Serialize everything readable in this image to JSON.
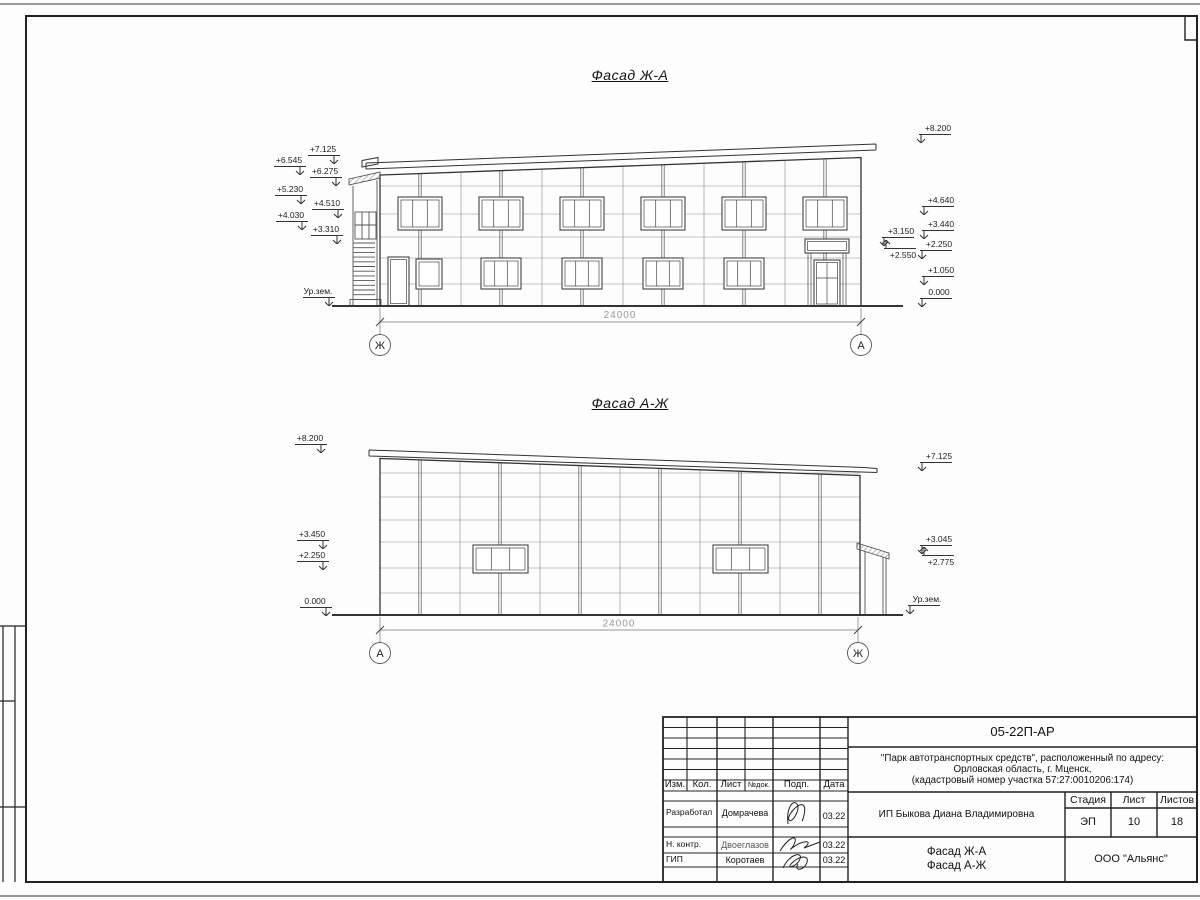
{
  "drawing": {
    "facade1": {
      "title": "Фасад Ж-А",
      "dimension": "24000",
      "axis_left": "Ж",
      "axis_right": "А",
      "marks": [
        {
          "label": "+7.125",
          "x": 308,
          "y": 155,
          "arrow": "r"
        },
        {
          "label": "+6.545",
          "x": 274,
          "y": 166,
          "arrow": "r"
        },
        {
          "label": "+6.275",
          "x": 310,
          "y": 177,
          "arrow": "r"
        },
        {
          "label": "+5.230",
          "x": 275,
          "y": 195,
          "arrow": "r"
        },
        {
          "label": "+4.510",
          "x": 312,
          "y": 209,
          "arrow": "r"
        },
        {
          "label": "+4.030",
          "x": 276,
          "y": 221,
          "arrow": "r"
        },
        {
          "label": "+3.310",
          "x": 311,
          "y": 235,
          "arrow": "r"
        },
        {
          "label": "Ур.зем.",
          "x": 303,
          "y": 297,
          "arrow": "r"
        },
        {
          "label": "+3.150",
          "x": 878,
          "y": 237,
          "arrow": "l"
        },
        {
          "label": "+2.550",
          "x": 880,
          "y": 248,
          "arrow": "l",
          "flip": true
        },
        {
          "label": "+8.200",
          "x": 915,
          "y": 134,
          "arrow": "l"
        },
        {
          "label": "+4.640",
          "x": 918,
          "y": 206,
          "arrow": "l"
        },
        {
          "label": "+3.440",
          "x": 918,
          "y": 230,
          "arrow": "l"
        },
        {
          "label": "+2.250",
          "x": 916,
          "y": 250,
          "arrow": "l"
        },
        {
          "label": "+1.050",
          "x": 918,
          "y": 276,
          "arrow": "l"
        },
        {
          "label": "0.000",
          "x": 916,
          "y": 298,
          "arrow": "l"
        }
      ]
    },
    "facade2": {
      "title": "Фасад А-Ж",
      "dimension": "24000",
      "axis_left": "А",
      "axis_right": "Ж",
      "marks": [
        {
          "label": "+8.200",
          "x": 295,
          "y": 444,
          "arrow": "r"
        },
        {
          "label": "+3.450",
          "x": 297,
          "y": 540,
          "arrow": "r"
        },
        {
          "label": "+2.250",
          "x": 297,
          "y": 561,
          "arrow": "r"
        },
        {
          "label": "0.000",
          "x": 300,
          "y": 607,
          "arrow": "r"
        },
        {
          "label": "+7.125",
          "x": 916,
          "y": 462,
          "arrow": "l"
        },
        {
          "label": "+3.045",
          "x": 916,
          "y": 545,
          "arrow": "l"
        },
        {
          "label": "+2.775",
          "x": 918,
          "y": 555,
          "arrow": "l",
          "flip": true
        },
        {
          "label": "Ур.зем.",
          "x": 904,
          "y": 605,
          "arrow": "l"
        }
      ]
    }
  },
  "titleblock": {
    "doc_number": "05-22П-АР",
    "project_lines": [
      "\"Парк автотранспортных средств\",  расположенный по адресу:",
      "Орловская область, г. Мценск,",
      "(кадастровый номер участка 57:27:0010206:174)"
    ],
    "client": "ИП Быкова Диана Владимировна",
    "sheet_title_line1": "Фасад Ж-А",
    "sheet_title_line2": "Фасад А-Ж",
    "organization": "ООО \"Альянс\"",
    "stage_label": "Стадия",
    "stage_value": "ЭП",
    "sheet_label": "Лист",
    "sheet_value": "10",
    "sheets_label": "Листов",
    "sheets_value": "18",
    "columns": [
      "Изм.",
      "Кол.",
      "Лист",
      "№док.",
      "Подп.",
      "Дата"
    ],
    "signers": [
      {
        "role": "Разработал",
        "name": "Домрачева",
        "date": "03.22"
      },
      {
        "role": "Н. контр.",
        "name": "Двоеглазов",
        "date": "03.22"
      },
      {
        "role": "ГИП",
        "name": "Коротаев",
        "date": "03.22"
      }
    ]
  }
}
